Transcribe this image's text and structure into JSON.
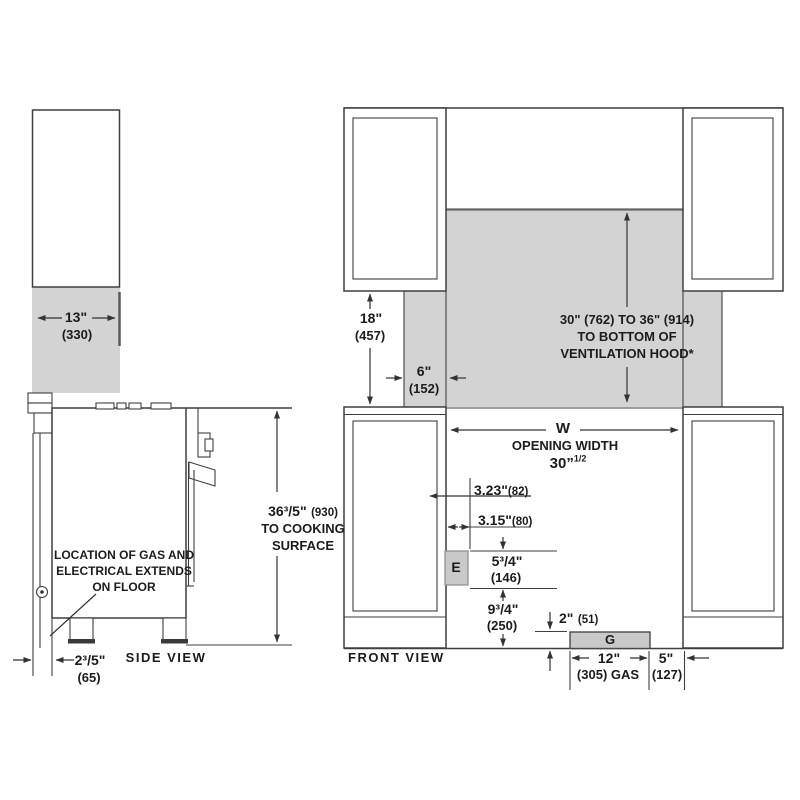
{
  "colors": {
    "wall_shading": "#d3d3d3",
    "line": "#3f3f3f",
    "text": "#1c1c1c",
    "utility_box": "#c9c9c9"
  },
  "side_view": {
    "label": "SIDE VIEW",
    "dim_cabinet_depth": {
      "in": "13\"",
      "mm": "(330)"
    },
    "dim_height": {
      "in": "36³/5\"",
      "mm": "(930)",
      "note_line1": "TO COOKING",
      "note_line2": "SURFACE"
    },
    "note": {
      "line1": "LOCATION OF GAS AND",
      "line2": "ELECTRICAL EXTENDS",
      "line3": "ON FLOOR"
    },
    "dim_back_clearance": {
      "in": "2³/5\"",
      "mm": "(65)"
    }
  },
  "front_view": {
    "label": "FRONT VIEW",
    "dim_counter_to_cabinet": {
      "in": "18\"",
      "mm": "(457)"
    },
    "dim_side_clearance": {
      "in": "6\"",
      "mm": "(152)"
    },
    "hood_note": {
      "line1": "30\" (762) TO 36\" (914)",
      "line2": "TO BOTTOM OF",
      "line3": "VENTILATION HOOD*"
    },
    "opening": {
      "symbol": "W",
      "label": "OPENING WIDTH",
      "value": "30”",
      "value_sup": "1/2"
    },
    "dim_electrical_1": {
      "in": "3.23\"",
      "mm": "(82)"
    },
    "dim_electrical_2": {
      "in": "3.15\"",
      "mm": "(80)"
    },
    "electrical_label": "E",
    "dim_electrical_height": {
      "in": "5³/4\"",
      "mm": "(146)"
    },
    "dim_electrical_floor": {
      "in": "9³/4\"",
      "mm": "(250)"
    },
    "dim_gas_height": {
      "in": "2\"",
      "mm": "(51)"
    },
    "gas_label": "G",
    "dim_gas_width": {
      "in": "12\"",
      "mm": "(305) GAS"
    },
    "dim_gas_offset": {
      "in": "5\"",
      "mm": "(127)"
    }
  }
}
